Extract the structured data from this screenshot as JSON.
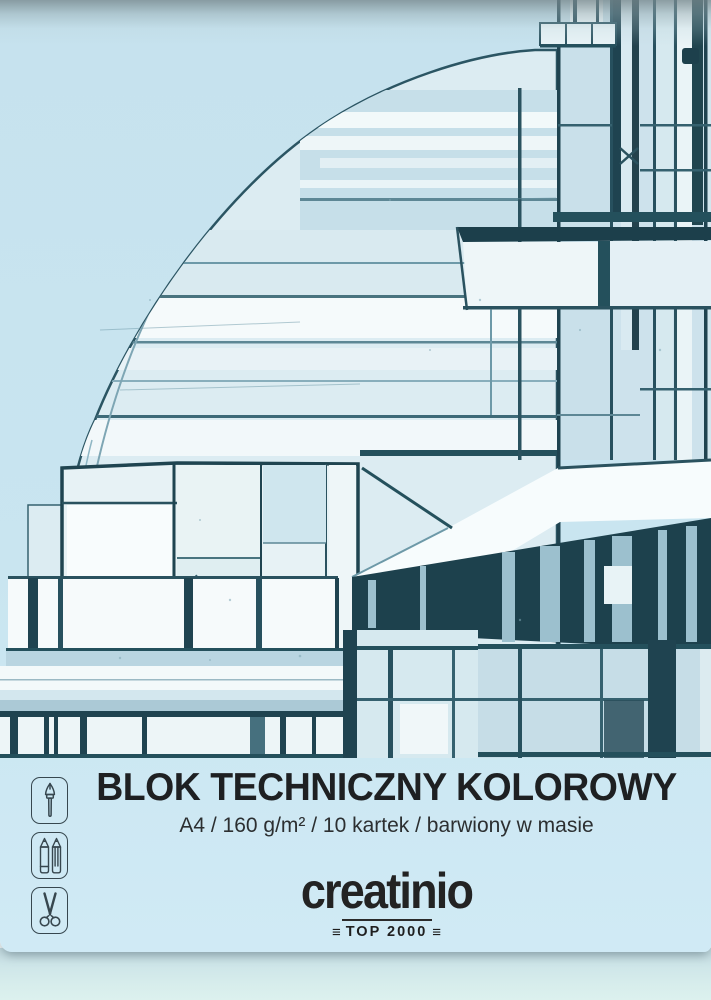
{
  "product": {
    "title": "BLOK TECHNICZNY KOLOROWY",
    "specs": "A4 / 160 g/m² / 10 kartek / barwiony w masie",
    "brand": "creatinio",
    "brand_badge": "TOP 2000",
    "badge_decor": "≡"
  },
  "icons": [
    {
      "name": "paintbrush-icon"
    },
    {
      "name": "pencils-icon"
    },
    {
      "name": "scissors-icon"
    }
  ],
  "artwork": {
    "subject": "architectural sketch of a modernist building with dome and towers"
  },
  "colors": {
    "cover_blue": "#c9e5f0",
    "page_edge": "#d7edec",
    "sketch_ink": "#1f4350",
    "sketch_wash": "#eef6f8",
    "text": "#1e2022"
  }
}
